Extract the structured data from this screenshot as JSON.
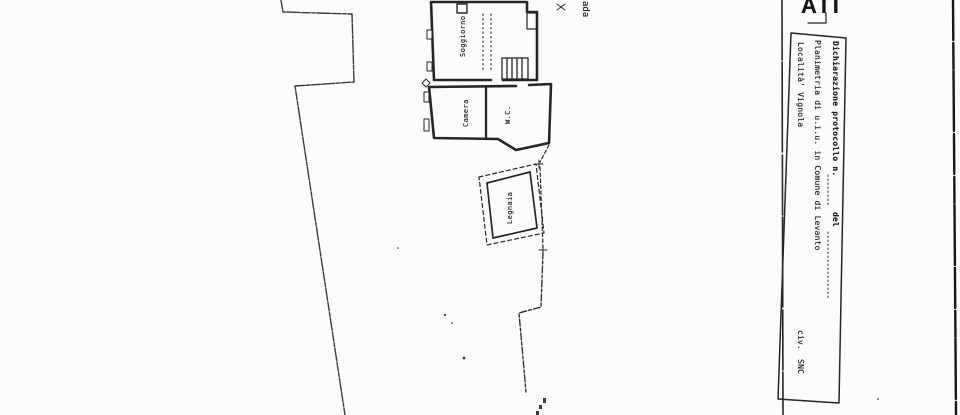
{
  "page": {
    "width": 960,
    "height": 415,
    "paper_color": "#fcfcfa",
    "ink_color": "#1d1d1d"
  },
  "stamp": {
    "partial_text": "ATI"
  },
  "plan": {
    "street_label_fragment": "ada",
    "rooms": [
      {
        "id": "soggiorno",
        "label": "Soggiorno"
      },
      {
        "id": "camera",
        "label": "Camera"
      },
      {
        "id": "wc",
        "label": "W.C."
      },
      {
        "id": "legnaia",
        "label": "Legnaia"
      }
    ]
  },
  "title_block": {
    "line1": {
      "label": "Dichiarazione protocollo n.",
      "mid_label": "del"
    },
    "line2": "Planimetria di u.i.u. in Comune di Levanto",
    "line3": {
      "label": "Località' Vignola",
      "civ_label": "civ.",
      "civ_value": "SNC"
    }
  }
}
